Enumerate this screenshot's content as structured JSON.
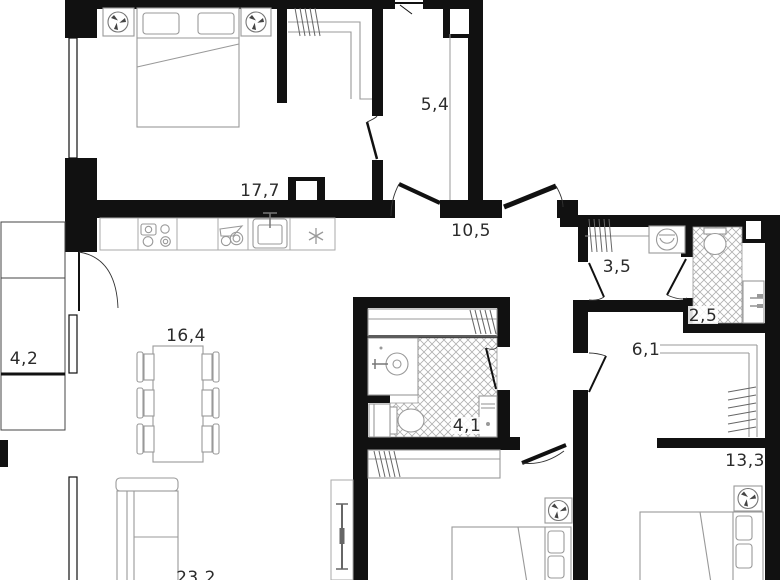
{
  "floorplan": {
    "rooms": [
      {
        "name": "bedroom-1",
        "area": "17,7"
      },
      {
        "name": "pantry",
        "area": "5,4"
      },
      {
        "name": "hallway",
        "area": "10,5"
      },
      {
        "name": "laundry",
        "area": "3,5"
      },
      {
        "name": "wc",
        "area": "2,5"
      },
      {
        "name": "corridor",
        "area": "6,1"
      },
      {
        "name": "bedroom-2",
        "area": "13,3"
      },
      {
        "name": "dining-area",
        "area": "16,4"
      },
      {
        "name": "balcony",
        "area": "4,2"
      },
      {
        "name": "bathroom",
        "area": "4,1"
      },
      {
        "name": "kitchen-living",
        "area": "23,2"
      }
    ],
    "colors": {
      "wall": "#111111",
      "furniture_line": "#999999",
      "label_text": "#2b2b2b",
      "background": "#ffffff"
    }
  }
}
